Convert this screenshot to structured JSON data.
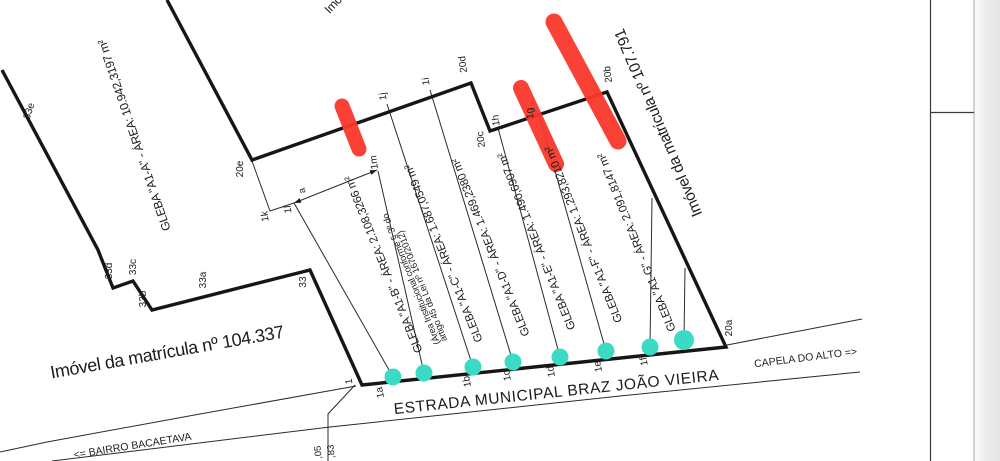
{
  "drawing": {
    "properties": {
      "left_parcel": "Imóvel da matrícula nº 104.337",
      "right_parcel": "Imóvel da matrícula nº 107.791",
      "top_parcel_fragment": "Imóvel"
    },
    "road": {
      "name": "ESTRADA MUNICIPAL BRAZ JOÃO VIEIRA",
      "direction_right": "CAPELA DO ALTO =>",
      "direction_left": "<= BAIRRO BACAETAVA"
    },
    "glebas": [
      {
        "id": "A1-A",
        "label": "GLEBA \"A1-A\" - ÁREA: 10.942,3197 m²"
      },
      {
        "id": "A1-B",
        "label": "GLEBA \"A1-B\" - ÁREA: 2.108,3266 m²",
        "note_line1": "(Área Institucional conforme § 3º do",
        "note_line2": "artigo 45 da Lei nº 1670/2012)"
      },
      {
        "id": "A1-C",
        "label": "GLEBA \"A1-C\" - ÁREA: 1.687,0549 m²"
      },
      {
        "id": "A1-D",
        "label": "GLEBA \"A1-D\" - ÁREA: 1.469,2380 m²"
      },
      {
        "id": "A1-E",
        "label": "GLEBA \"A1-E\" - ÁREA: 1.490,6907 m²"
      },
      {
        "id": "A1-F",
        "label": "GLEBA \"A1-F\" - ÁREA: 1.293,8210 m²"
      },
      {
        "id": "A1-G",
        "label": "GLEBA \"A1-G\" - ÁREA: 2.091,8147 m²"
      }
    ],
    "vertex_labels": [
      "33e",
      "33d",
      "33c",
      "33b",
      "33a",
      "33",
      "1",
      "1a",
      "1b",
      "1c",
      "1d",
      "1e",
      "1f",
      "20a",
      "20b",
      "20c",
      "20d",
      "20e",
      "1j",
      "1i",
      "1h",
      "1g",
      "1k",
      "1l",
      "1m"
    ],
    "dimension_labels": {
      "a": "a",
      "d05": ",05",
      "d83": ",83"
    },
    "colors": {
      "marker_red": "#f9372c",
      "dot_teal": "#3bdac5",
      "line": "#1c1c1c",
      "page_edge": "#e6e6e6"
    }
  }
}
